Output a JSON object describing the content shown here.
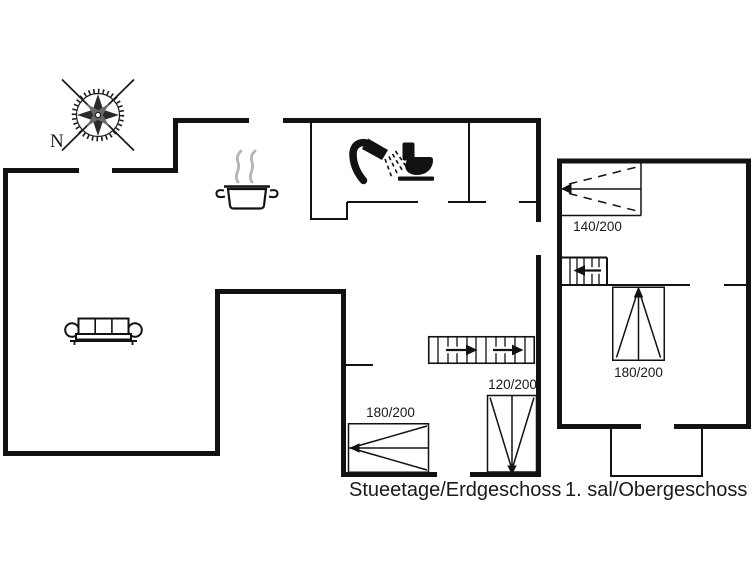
{
  "plan": {
    "type": "holiday-house floor plan",
    "background": "#ffffff",
    "wall_color": "#121212",
    "steam_color": "#b5b5b5"
  },
  "compass": {
    "north_label": "N"
  },
  "floors": {
    "ground": {
      "label": "Stueetage/Erdgeschoss"
    },
    "upper": {
      "label": "1. sal/Obergeschoss"
    }
  },
  "beds": [
    {
      "floor": "upper",
      "size": "140/200"
    },
    {
      "floor": "upper",
      "size": "180/200"
    },
    {
      "floor": "ground",
      "size": "120/200"
    },
    {
      "floor": "ground",
      "size": "180/200"
    }
  ],
  "icons": {
    "compass": "compass-rose-icon",
    "kitchen": "cooking-pot-icon",
    "bathroom_shower": "shower-icon",
    "bathroom_toilet": "toilet-icon",
    "living_room": "sofa-icon",
    "stairs_ground": "stairs-up-icon",
    "stairs_upper": "stairs-down-icon"
  }
}
